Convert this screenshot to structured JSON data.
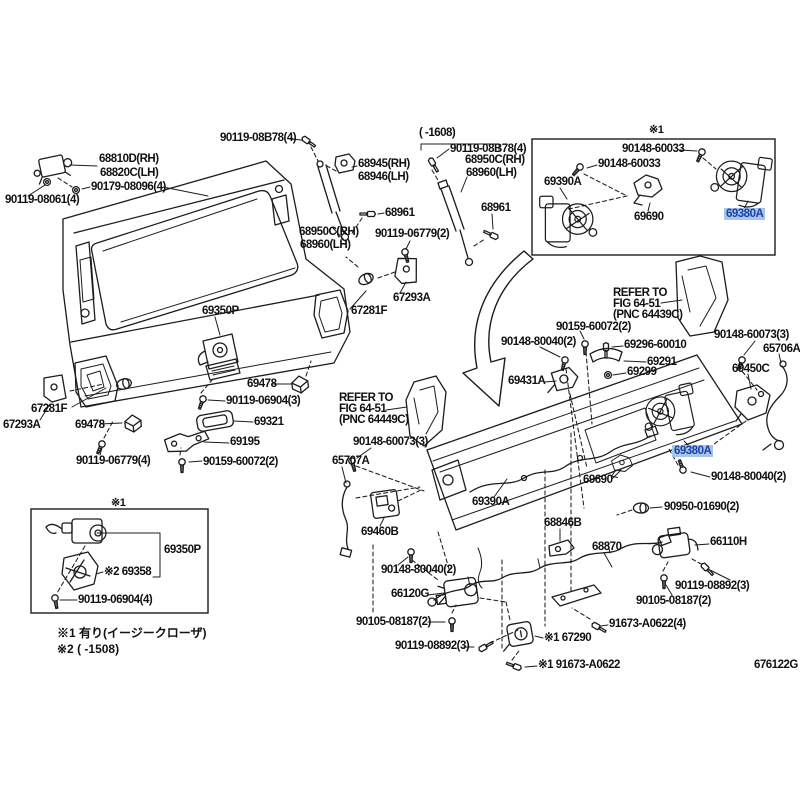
{
  "diagram": {
    "kind": "parts-diagram",
    "highlight_bg": "#a6c6e8",
    "highlight_fg": "#1c3fa8",
    "line_color": "#1c1c1c",
    "footer": {
      "drawing_number": "676122G"
    },
    "notes": {
      "n1": "※1 有り(イージークローザ)",
      "n2": "※2 (      -1508)"
    },
    "labels": {
      "l68810d": "68810D(RH)",
      "l68820c": "68820C(LH)",
      "l90179_08096": "90179-08096(4)",
      "l90119_08061": "90119-08061(4)",
      "l90119_08b78_a": "90119-08B78(4)",
      "l68945": "68945(RH)",
      "l68946": "68946(LH)",
      "l68961_a": "68961",
      "l68950c_a": "68950C(RH)",
      "l68960_a": "68960(LH)",
      "l90119_06779_2": "90119-06779(2)",
      "lrange_1608": "(    -1608)",
      "l90119_08b78_b": "90119-08B78(4)",
      "l68950c_b": "68950C(RH)",
      "l68960_b": "68960(LH)",
      "l68961_b": "68961",
      "lbox1_marker": "※1",
      "l90148_60033_a": "90148-60033",
      "l90148_60033_b": "90148-60033",
      "l69390a_a": "69390A",
      "l69690_a": "69690",
      "l69380a_a": "69380A",
      "l69350p_a": "69350P",
      "l67281f_a": "67281F",
      "l67293a_a": "67293A",
      "l67281f_b": "67281F",
      "l67293a_b": "67293A",
      "l69478_a": "69478",
      "l90119_06904_3": "90119-06904(3)",
      "l69478_b": "69478",
      "l69321": "69321",
      "l69195": "69195",
      "l90119_06779_4": "90119-06779(4)",
      "l90159_60072_a": "90159-60072(2)",
      "lrefer1_1": "REFER TO",
      "lrefer1_2": "FIG 64-51",
      "lrefer1_3": "(PNC 64439C)",
      "l90159_60072_b": "90159-60072(2)",
      "l90148_80040_a": "90148-80040(2)",
      "l69296_60010": "69296-60010",
      "l69291": "69291",
      "l69299": "69299",
      "l69431a": "69431A",
      "l90148_60073_a": "90148-60073(3)",
      "l65706a": "65706A",
      "l69450c": "69450C",
      "lrefer2_1": "REFER TO",
      "lrefer2_2": "FIG 64-51",
      "lrefer2_3": "(PNC 64449C)",
      "l90148_60073_b": "90148-60073(3)",
      "l65707a": "65707A",
      "l69460b": "69460B",
      "l69390a_b": "69390A",
      "l68846b": "68846B",
      "l69690_b": "69690",
      "l69380a_b": "69380A",
      "l90148_80040_b": "90148-80040(2)",
      "l90950_01690": "90950-01690(2)",
      "l68870": "68870",
      "l66110h": "66110H",
      "l90148_80040_c": "90148-80040(2)",
      "l66120g": "66120G",
      "l90105_08187_a": "90105-08187(2)",
      "l90119_08892_a": "90119-08892(3)",
      "l67290": "※1 67290",
      "l91673_a0622_s": "※1 91673-A0622",
      "l91673_a0622_4": "91673-A0622(4)",
      "l90105_08187_b": "90105-08187(2)",
      "l90119_08892_b": "90119-08892(3)",
      "lbox2_marker": "※1",
      "l69350p_b": "69350P",
      "l69358": "※2 69358",
      "l90119_06904_4": "90119-06904(4)"
    }
  }
}
